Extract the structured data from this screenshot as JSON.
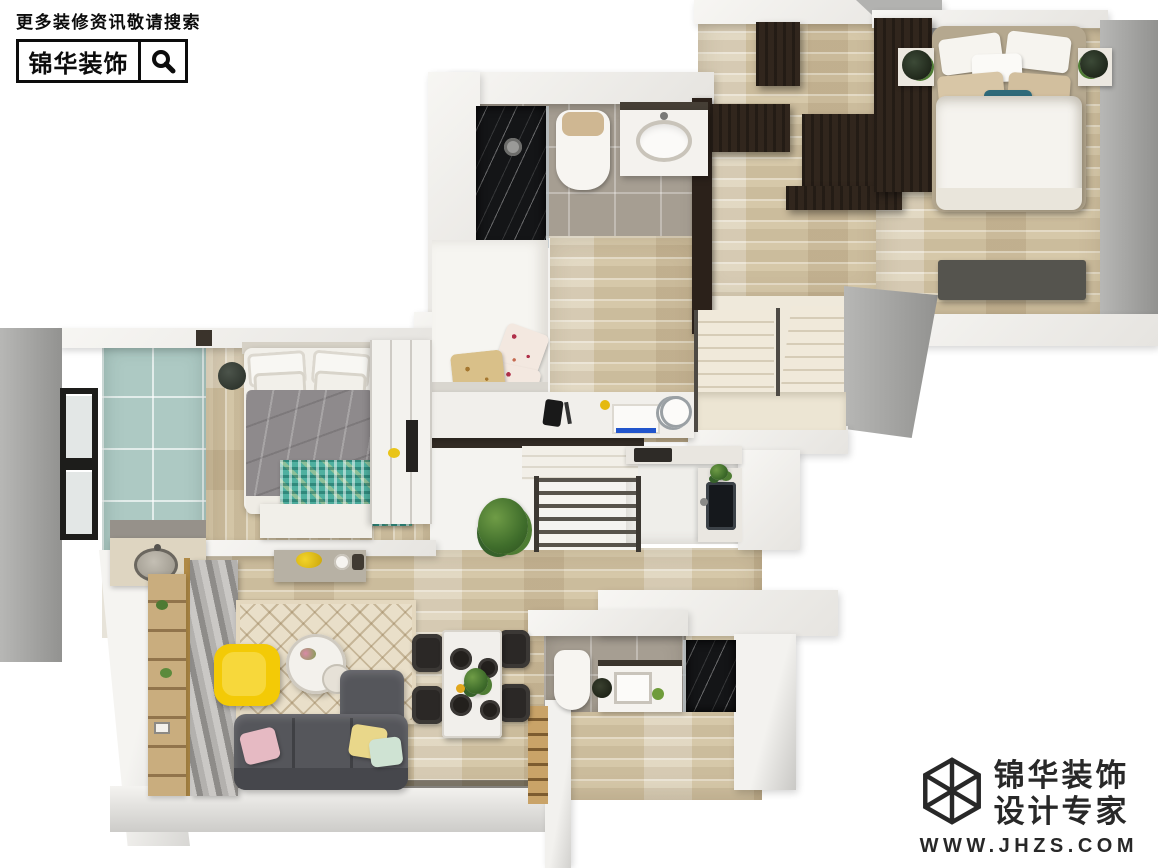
{
  "canvas": {
    "width": 1158,
    "height": 868,
    "background": "#ffffff"
  },
  "watermark_top": {
    "tagline": "更多装修资讯敬请搜索",
    "brand": "锦华装饰",
    "search_icon": "magnifier-icon",
    "text_color": "#0c0c0c"
  },
  "watermark_bottom": {
    "brand": "锦华装饰",
    "subtitle": "设计专家",
    "website": "WWW.JHZS.COM",
    "logo_icon": "cube-wireframe-icon",
    "text_color": "#282828"
  },
  "floorplan": {
    "type": "3d-top-down-apartment-render",
    "rooms": [
      {
        "id": "bedroom-top-right",
        "features": [
          "double-bed-white-bedding",
          "teal-accent-pillow",
          "dark-wenge-wardrobe",
          "nightstands-with-plants",
          "tv-bench"
        ]
      },
      {
        "id": "walk-in-closet",
        "features": [
          "dark-wenge-cabinets",
          "wood-floor"
        ]
      },
      {
        "id": "bathroom-upper",
        "features": [
          "black-marble-shower",
          "toilet",
          "vanity-with-sink",
          "grey-floor-tiles"
        ]
      },
      {
        "id": "study-bedroom",
        "features": [
          "white-platform-bed",
          "floral-pillows",
          "white-desk"
        ]
      },
      {
        "id": "staircase-upper",
        "features": [
          "two-flights",
          "metal-railing",
          "landing"
        ]
      },
      {
        "id": "staircase-center",
        "features": [
          "metal-railing",
          "potted-plant"
        ]
      },
      {
        "id": "master-bedroom-left",
        "features": [
          "grey-duvet-bed",
          "teal-mosaic-rug",
          "round-bedside-stools",
          "white-wardrobe",
          "wall-tv"
        ]
      },
      {
        "id": "balcony",
        "features": [
          "seafoam-tiles",
          "window",
          "laundry-counter-round-sink"
        ]
      },
      {
        "id": "living-room",
        "features": [
          "grey-l-shaped-sofa",
          "yellow-armchair",
          "round-coffee-table",
          "diamond-pattern-rug",
          "curtains",
          "ladder-shelf",
          "console"
        ]
      },
      {
        "id": "dining-area",
        "features": [
          "marble-dining-table",
          "four-black-chairs",
          "plant-centerpiece"
        ]
      },
      {
        "id": "kitchen",
        "features": [
          "double-basin-sink",
          "white-counters",
          "cooktop"
        ]
      },
      {
        "id": "bathroom-lower",
        "features": [
          "toilet",
          "vanity-with-sink",
          "black-marble-shower",
          "grey-floor-tiles"
        ]
      }
    ],
    "palette": {
      "wood_floor": "#d6c8a9",
      "wall_grey": "#a2a2a0",
      "wall_white": "#f3f2ef",
      "tile_grey": "#a69e92",
      "tile_seafoam": "#adc9c3",
      "dark_wenge": "#31261d",
      "marble_black": "#141517",
      "sofa_grey": "#55565b",
      "accent_yellow": "#f3ca06",
      "rug_teal": "#4fb0a0",
      "duvet_grey": "#8e8a8c",
      "pillow_pink": "#e6bac3",
      "pillow_mint": "#cfe3d3",
      "pillow_yellow": "#e9d78a",
      "stair_cream": "#ece5d3"
    }
  }
}
